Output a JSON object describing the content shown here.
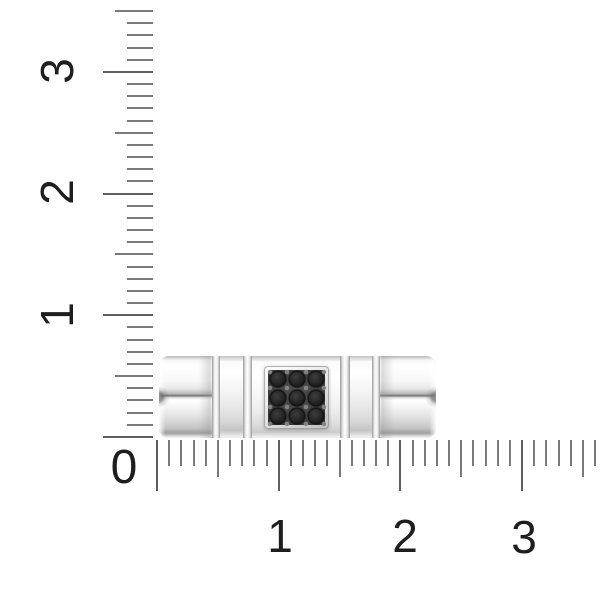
{
  "scene": {
    "description": "Side view of a polished white-metal segmented ring band with a square plate of black pave stones, photographed against centimeter rulers",
    "metal_color": "#f3f3f3",
    "stone_color": "#1b1b1b",
    "stone_bed_color": "#3e3e3e",
    "stones_rows": 3,
    "stones_cols": 3
  },
  "rulers": {
    "tick_color": "#7a7a7a",
    "number_color": "#1e1e1e",
    "origin_label": "0",
    "vertical": {
      "labels": [
        "1",
        "2",
        "3"
      ],
      "tick_count": 36
    },
    "horizontal": {
      "labels": [
        "1",
        "2",
        "3"
      ],
      "tick_count": 37
    }
  }
}
